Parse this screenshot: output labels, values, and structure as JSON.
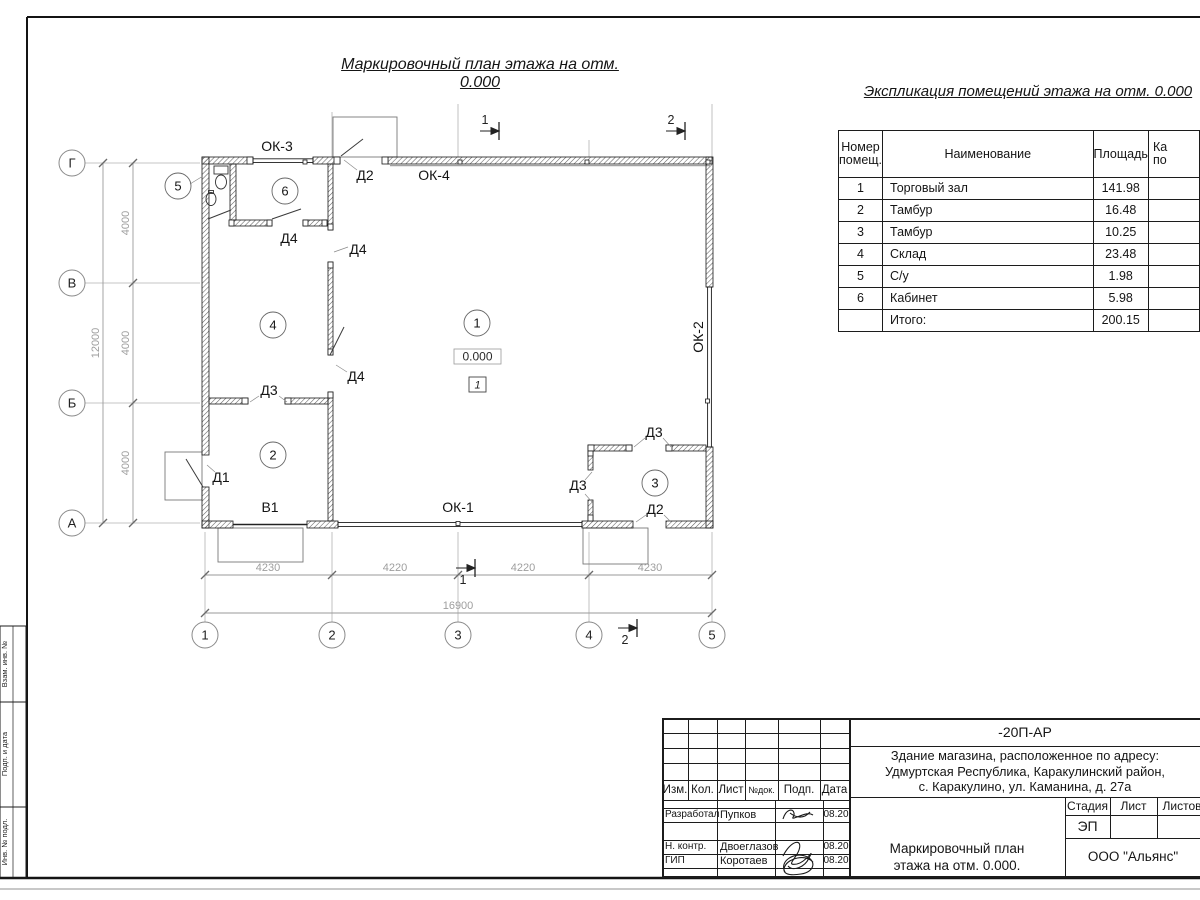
{
  "page": {
    "plan_title": "Маркировочный план этажа на отм. 0.000",
    "table_title": "Экспликация помещений этажа на отм. 0.000"
  },
  "expl_table": {
    "headers": {
      "num1": "Номер",
      "num2": "помещ.",
      "name": "Наименование",
      "area": "Площадь",
      "cut1": "Ка",
      "cut2": "по"
    },
    "rows": [
      {
        "num": "1",
        "name": "Торговый зал",
        "area": "141.98"
      },
      {
        "num": "2",
        "name": "Тамбур",
        "area": "16.48"
      },
      {
        "num": "3",
        "name": "Тамбур",
        "area": "10.25"
      },
      {
        "num": "4",
        "name": "Склад",
        "area": "23.48"
      },
      {
        "num": "5",
        "name": "С/у",
        "area": "1.98"
      },
      {
        "num": "6",
        "name": "Кабинет",
        "area": "5.98"
      }
    ],
    "total_label": "Итого:",
    "total_value": "200.15"
  },
  "plan": {
    "labels": {
      "d1": "Д1",
      "d2": "Д2",
      "d3": "Д3",
      "d4": "Д4",
      "ok1": "ОК-1",
      "ok2": "ОК-2",
      "ok3": "ОК-3",
      "ok4": "ОК-4",
      "v1": "В1"
    },
    "rooms": {
      "r1": "1",
      "r2": "2",
      "r3": "3",
      "r4": "4",
      "r5": "5",
      "r6": "6"
    },
    "elevation": "0.000",
    "floor_type": "1",
    "sections": {
      "s1": "1",
      "s2": "2"
    },
    "axes_cols": [
      "1",
      "2",
      "3",
      "4",
      "5"
    ],
    "axes_rows": [
      "Г",
      "В",
      "Б",
      "А"
    ],
    "dims_bottom": [
      "4230",
      "4220",
      "4220",
      "4230"
    ],
    "dim_bottom_total": "16900",
    "dims_left": [
      "4000",
      "4000",
      "4000"
    ],
    "dim_left_total": "12000"
  },
  "titleblock": {
    "doc_code": "-20П-АР",
    "address_line1": "Здание магазина, расположенное по адресу:",
    "address_line2": "Удмуртская Республика, Каракулинский район,",
    "address_line3": "с. Каракулино, ул. Каманина, д. 27а",
    "change_headers": {
      "izm": "Изм.",
      "kol": "Кол.",
      "list": "Лист",
      "ndok": "№док.",
      "podp": "Подп.",
      "data": "Дата"
    },
    "rows": [
      {
        "role": "Разработал",
        "name": "Пупков",
        "date": "08.20"
      },
      {
        "role": "Н. контр.",
        "name": "Двоеглазов",
        "date": "08.20"
      },
      {
        "role": "ГИП",
        "name": "Коротаев",
        "date": "08.20"
      }
    ],
    "stage_label": "Стадия",
    "sheet_label": "Лист",
    "sheets_label": "Листов",
    "stage_value": "ЭП",
    "title_line1": "Маркировочный план",
    "title_line2": "этажа на отм. 0.000.",
    "company": "ООО \"Альянс\""
  },
  "side_stamp": {
    "box1": "Взам. инв. №",
    "box2": "Подп. и дата",
    "box3": "Инв. № подл."
  }
}
